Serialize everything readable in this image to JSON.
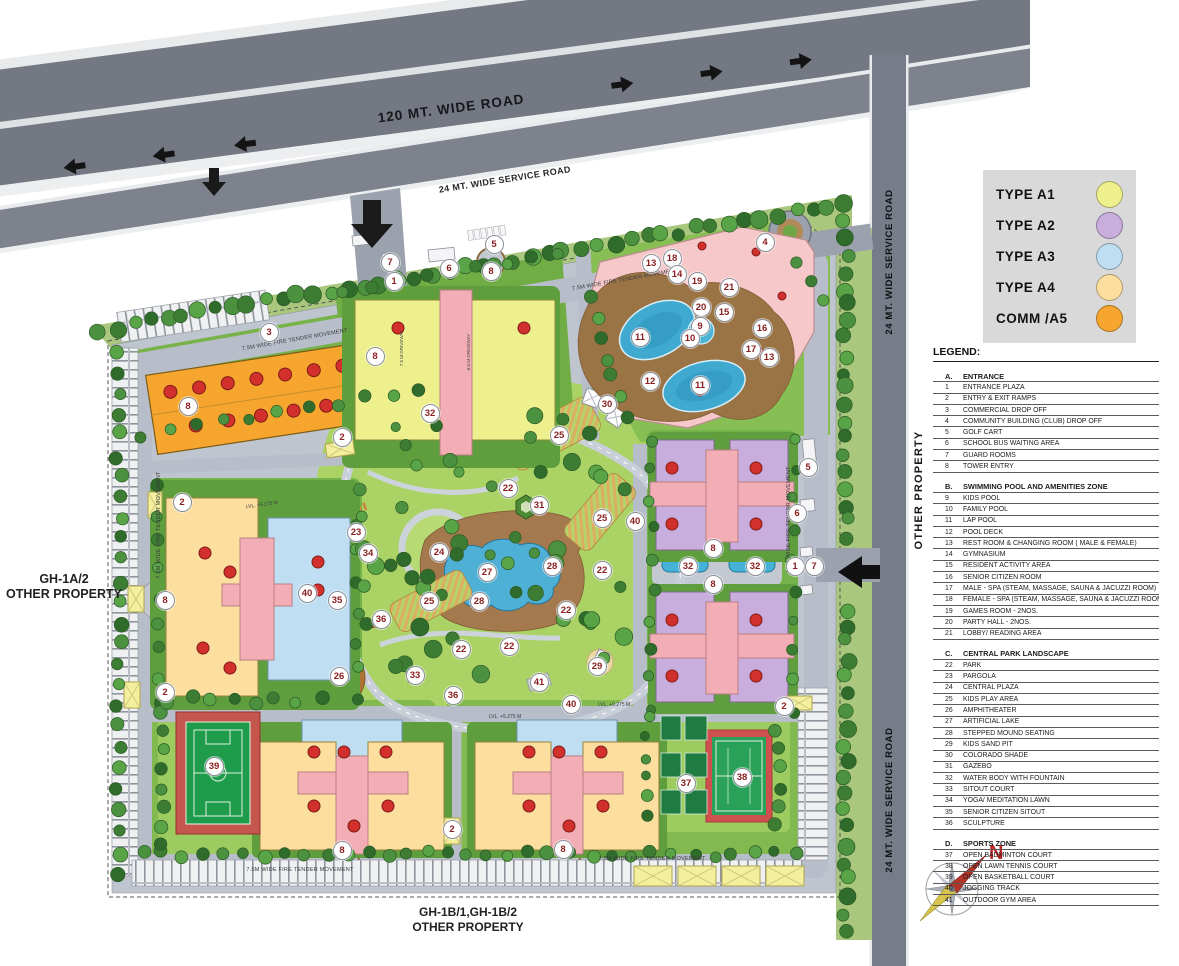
{
  "map": {
    "highway_label": "120 MT. WIDE ROAD",
    "service_road_label": "24 MT. WIDE SERVICE ROAD",
    "right_road_label_top": "24 MT. WIDE SERVICE ROAD",
    "right_road_label_bottom": "24 MT. WIDE SERVICE ROAD",
    "other_property_right": "OTHER PROPERTY",
    "gh1a_line1": "GH-1A/2",
    "gh1a_line2": "OTHER PROPERTY",
    "gh1b_line1": "GH-1B/1,GH-1B/2",
    "gh1b_line2": "OTHER PROPERTY",
    "fire_tender_label": "7.5M WIDE FIRE TENDER MOVEMENT",
    "driveway_75_label": "7.5 M DRIVEWAY",
    "driveway_60_label": "6.0 M DRIVEWAY",
    "level_labels": [
      "LVL. +5.175 M",
      "LVL. +5.275 M",
      "LVL. +0.275 M"
    ],
    "north_label": "N"
  },
  "type_legend": {
    "items": [
      {
        "label": "TYPE A1",
        "color": "#eef08d"
      },
      {
        "label": "TYPE A2",
        "color": "#c9aedd"
      },
      {
        "label": "TYPE A3",
        "color": "#bfdef2"
      },
      {
        "label": "TYPE A4",
        "color": "#fcdf9f"
      },
      {
        "label": "COMM /A5",
        "color": "#f6a62e"
      }
    ]
  },
  "legend": {
    "title": "LEGEND:",
    "sections": [
      {
        "id": "A.",
        "title": "ENTRANCE",
        "items": [
          {
            "num": "1",
            "label": "ENTRANCE PLAZA"
          },
          {
            "num": "2",
            "label": "ENTRY & EXIT RAMPS"
          },
          {
            "num": "3",
            "label": "COMMERCIAL DROP OFF"
          },
          {
            "num": "4",
            "label": "COMMUNITY BUILDING (CLUB) DROP OFF"
          },
          {
            "num": "5",
            "label": "GOLF CART"
          },
          {
            "num": "6",
            "label": "SCHOOL BUS WAITING AREA"
          },
          {
            "num": "7",
            "label": "GUARD ROOMS"
          },
          {
            "num": "8",
            "label": "TOWER ENTRY"
          }
        ]
      },
      {
        "id": "B.",
        "title": "SWIMMING POOL AND AMENITIES ZONE",
        "items": [
          {
            "num": "9",
            "label": "KIDS POOL"
          },
          {
            "num": "10",
            "label": "FAMILY POOL"
          },
          {
            "num": "11",
            "label": "LAP POOL"
          },
          {
            "num": "12",
            "label": "POOL DECK"
          },
          {
            "num": "13",
            "label": "REST ROOM & CHANGING ROOM ( MALE & FEMALE)"
          },
          {
            "num": "14",
            "label": "GYMNASIUM"
          },
          {
            "num": "15",
            "label": "RESIDENT ACTIVITY AREA"
          },
          {
            "num": "16",
            "label": "SENIOR CITIZEN ROOM"
          },
          {
            "num": "17",
            "label": "MALE - SPA (STEAM, MASSAGE, SAUNA & JACUZZI ROOM)"
          },
          {
            "num": "18",
            "label": "FEMALE - SPA (STEAM, MASSAGE, SAUNA & JACUZZI ROOM)"
          },
          {
            "num": "19",
            "label": "GAMES ROOM - 2NOS."
          },
          {
            "num": "20",
            "label": "PARTY HALL - 2NOS."
          },
          {
            "num": "21",
            "label": "LOBBY/ READING AREA"
          }
        ]
      },
      {
        "id": "C.",
        "title": "CENTRAL PARK LANDSCAPE",
        "items": [
          {
            "num": "22",
            "label": "PARK"
          },
          {
            "num": "23",
            "label": "PARGOLA"
          },
          {
            "num": "24",
            "label": "CENTRAL PLAZA"
          },
          {
            "num": "25",
            "label": "KIDS PLAY AREA"
          },
          {
            "num": "26",
            "label": "AMPHITHEATER"
          },
          {
            "num": "27",
            "label": "ARTIFICIAL LAKE"
          },
          {
            "num": "28",
            "label": "STEPPED MOUND SEATING"
          },
          {
            "num": "29",
            "label": "KIDS SAND PIT"
          },
          {
            "num": "30",
            "label": "COLORADO SHADE"
          },
          {
            "num": "31",
            "label": "GAZEBO"
          },
          {
            "num": "32",
            "label": "WATER BODY WITH FOUNTAIN"
          },
          {
            "num": "33",
            "label": "SITOUT COURT"
          },
          {
            "num": "34",
            "label": "YOGA/ MEDITATION LAWN"
          },
          {
            "num": "35",
            "label": "SENIOR CITIZEN SITOUT"
          },
          {
            "num": "36",
            "label": "SCULPTURE"
          }
        ]
      },
      {
        "id": "D.",
        "title": "SPORTS ZONE",
        "items": [
          {
            "num": "37",
            "label": "OPEN BADMINTON COURT"
          },
          {
            "num": "38",
            "label": "OPEN LAWN TENNIS COURT"
          },
          {
            "num": "39",
            "label": "OPEN BASKETBALL COURT"
          },
          {
            "num": "40",
            "label": "JOGGING TRACK"
          },
          {
            "num": "41",
            "label": "OUTDOOR GYM AREA"
          }
        ]
      }
    ]
  },
  "map_markers": [
    {
      "n": "7",
      "x": 390,
      "y": 262
    },
    {
      "n": "1",
      "x": 394,
      "y": 281
    },
    {
      "n": "6",
      "x": 449,
      "y": 268
    },
    {
      "n": "5",
      "x": 494,
      "y": 244
    },
    {
      "n": "8",
      "x": 491,
      "y": 271
    },
    {
      "n": "4",
      "x": 765,
      "y": 242
    },
    {
      "n": "18",
      "x": 672,
      "y": 258
    },
    {
      "n": "13",
      "x": 651,
      "y": 263
    },
    {
      "n": "14",
      "x": 677,
      "y": 274
    },
    {
      "n": "19",
      "x": 697,
      "y": 281
    },
    {
      "n": "21",
      "x": 729,
      "y": 287
    },
    {
      "n": "20",
      "x": 701,
      "y": 307
    },
    {
      "n": "15",
      "x": 724,
      "y": 312
    },
    {
      "n": "9",
      "x": 700,
      "y": 326
    },
    {
      "n": "16",
      "x": 762,
      "y": 328
    },
    {
      "n": "10",
      "x": 690,
      "y": 338
    },
    {
      "n": "11",
      "x": 640,
      "y": 337
    },
    {
      "n": "17",
      "x": 751,
      "y": 349
    },
    {
      "n": "13",
      "x": 769,
      "y": 357
    },
    {
      "n": "12",
      "x": 650,
      "y": 381
    },
    {
      "n": "11",
      "x": 700,
      "y": 385
    },
    {
      "n": "3",
      "x": 269,
      "y": 332
    },
    {
      "n": "8",
      "x": 375,
      "y": 356
    },
    {
      "n": "8",
      "x": 188,
      "y": 406
    },
    {
      "n": "2",
      "x": 342,
      "y": 437
    },
    {
      "n": "32",
      "x": 430,
      "y": 413
    },
    {
      "n": "30",
      "x": 607,
      "y": 404
    },
    {
      "n": "25",
      "x": 559,
      "y": 435
    },
    {
      "n": "2",
      "x": 182,
      "y": 502
    },
    {
      "n": "22",
      "x": 508,
      "y": 488
    },
    {
      "n": "31",
      "x": 539,
      "y": 505
    },
    {
      "n": "25",
      "x": 602,
      "y": 518
    },
    {
      "n": "40",
      "x": 635,
      "y": 521
    },
    {
      "n": "23",
      "x": 356,
      "y": 532
    },
    {
      "n": "34",
      "x": 368,
      "y": 553
    },
    {
      "n": "24",
      "x": 439,
      "y": 552
    },
    {
      "n": "27",
      "x": 487,
      "y": 572
    },
    {
      "n": "28",
      "x": 552,
      "y": 566
    },
    {
      "n": "22",
      "x": 602,
      "y": 570
    },
    {
      "n": "35",
      "x": 337,
      "y": 600
    },
    {
      "n": "25",
      "x": 429,
      "y": 601
    },
    {
      "n": "28",
      "x": 479,
      "y": 601
    },
    {
      "n": "40",
      "x": 307,
      "y": 593
    },
    {
      "n": "22",
      "x": 566,
      "y": 610
    },
    {
      "n": "36",
      "x": 381,
      "y": 619
    },
    {
      "n": "22",
      "x": 461,
      "y": 649
    },
    {
      "n": "22",
      "x": 509,
      "y": 646
    },
    {
      "n": "33",
      "x": 415,
      "y": 675
    },
    {
      "n": "26",
      "x": 339,
      "y": 676
    },
    {
      "n": "29",
      "x": 597,
      "y": 666
    },
    {
      "n": "41",
      "x": 539,
      "y": 682
    },
    {
      "n": "36",
      "x": 453,
      "y": 695
    },
    {
      "n": "40",
      "x": 571,
      "y": 704
    },
    {
      "n": "8",
      "x": 165,
      "y": 600
    },
    {
      "n": "2",
      "x": 165,
      "y": 692
    },
    {
      "n": "5",
      "x": 808,
      "y": 467
    },
    {
      "n": "6",
      "x": 797,
      "y": 513
    },
    {
      "n": "8",
      "x": 713,
      "y": 548
    },
    {
      "n": "32",
      "x": 688,
      "y": 566
    },
    {
      "n": "32",
      "x": 755,
      "y": 566
    },
    {
      "n": "1",
      "x": 795,
      "y": 566
    },
    {
      "n": "7",
      "x": 814,
      "y": 566
    },
    {
      "n": "8",
      "x": 713,
      "y": 584
    },
    {
      "n": "2",
      "x": 784,
      "y": 706
    },
    {
      "n": "39",
      "x": 214,
      "y": 766
    },
    {
      "n": "37",
      "x": 686,
      "y": 783
    },
    {
      "n": "38",
      "x": 742,
      "y": 777
    },
    {
      "n": "2",
      "x": 452,
      "y": 829
    },
    {
      "n": "8",
      "x": 342,
      "y": 850
    },
    {
      "n": "8",
      "x": 563,
      "y": 849
    }
  ]
}
